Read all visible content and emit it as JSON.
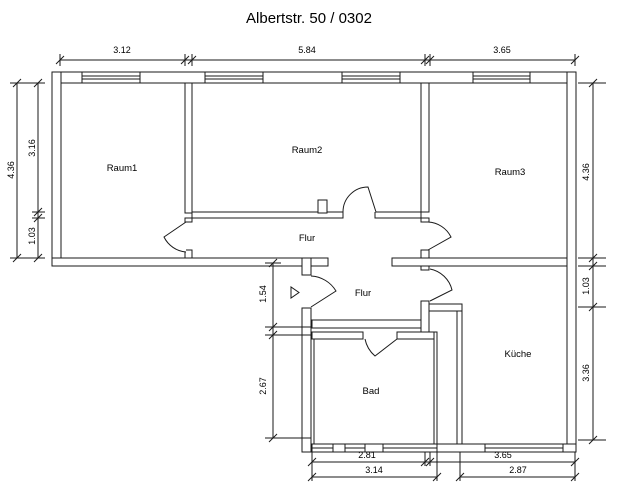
{
  "title": "Albertstr. 50 / 0302",
  "rooms": {
    "raum1": "Raum1",
    "raum2": "Raum2",
    "raum3": "Raum3",
    "flur_upper": "Flur",
    "flur_lower": "Flur",
    "bad": "Bad",
    "kueche": "Küche"
  },
  "dimensions": {
    "top": [
      "3.12",
      "5.84",
      "3.65"
    ],
    "left": {
      "total": "4.36",
      "upper": "3.16",
      "lower": "1.03"
    },
    "right": {
      "upper": "4.36",
      "middle": "1.03",
      "lower": "3.36"
    },
    "inner": {
      "flur_depth": "1.54",
      "bad_height": "2.67"
    },
    "bottom_inner": [
      "2.81",
      "3.65"
    ],
    "bottom_outer": [
      "3.14",
      "2.87"
    ]
  },
  "colors": {
    "line": "#1a1a1a",
    "background": "#ffffff"
  }
}
